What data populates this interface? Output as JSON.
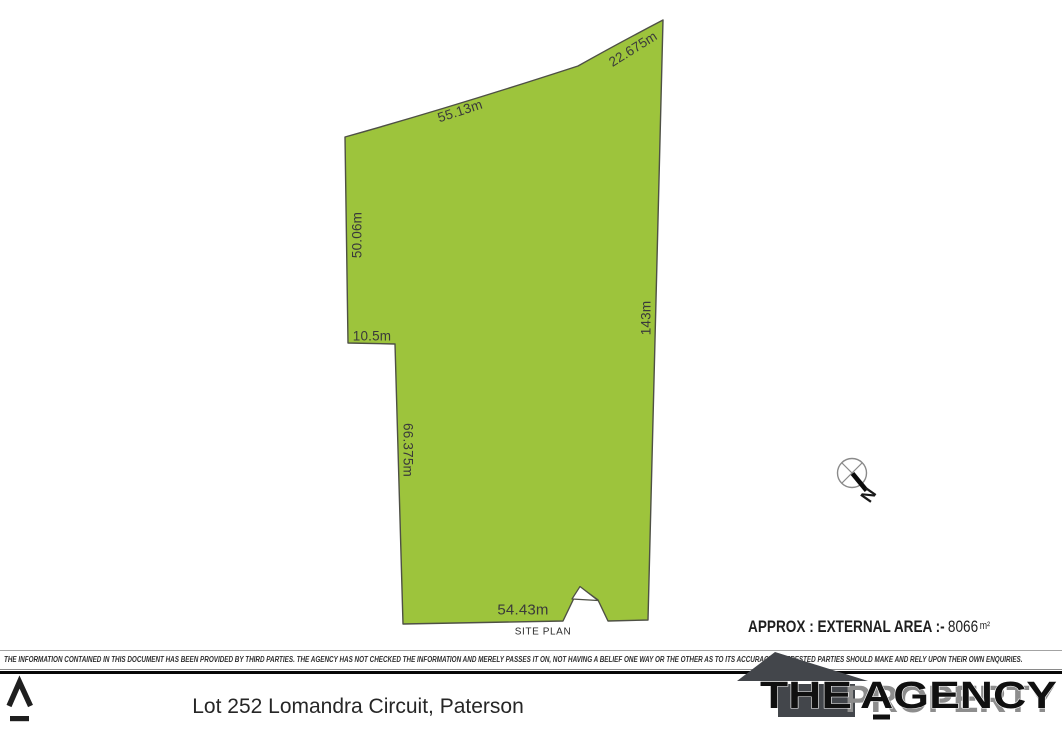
{
  "site_plan": {
    "fill_color": "#9dc43c",
    "stroke_color": "#4e5045",
    "boundaries": {
      "top": "55.13m",
      "top_right": "22.675m",
      "left_upper": "50.06m",
      "step": "10.5m",
      "left_lower": "66.375m",
      "right": "143m",
      "bottom": "54.43m"
    },
    "caption": "SITE PLAN",
    "area": {
      "label": "APPROX : EXTERNAL AREA :-",
      "value": "8066",
      "unit": "m²"
    },
    "compass": {
      "letter": "N"
    }
  },
  "disclaimer": "THE INFORMATION CONTAINED IN THIS DOCUMENT HAS BEEN PROVIDED BY THIRD PARTIES. THE AGENCY HAS NOT CHECKED THE INFORMATION AND MERELY PASSES IT ON, NOT HAVING A BELIEF ONE WAY OR THE OTHER AS TO ITS ACCURACY. INTERESTED PARTIES SHOULD MAKE AND RELY UPON THEIR OWN ENQUIRIES.",
  "footer": {
    "title": "Lot 252 Lomandra Circuit, Paterson",
    "logo": {
      "word_the": "THE",
      "word_agency": "AGENCY",
      "word_property": "PROPERTY"
    }
  }
}
